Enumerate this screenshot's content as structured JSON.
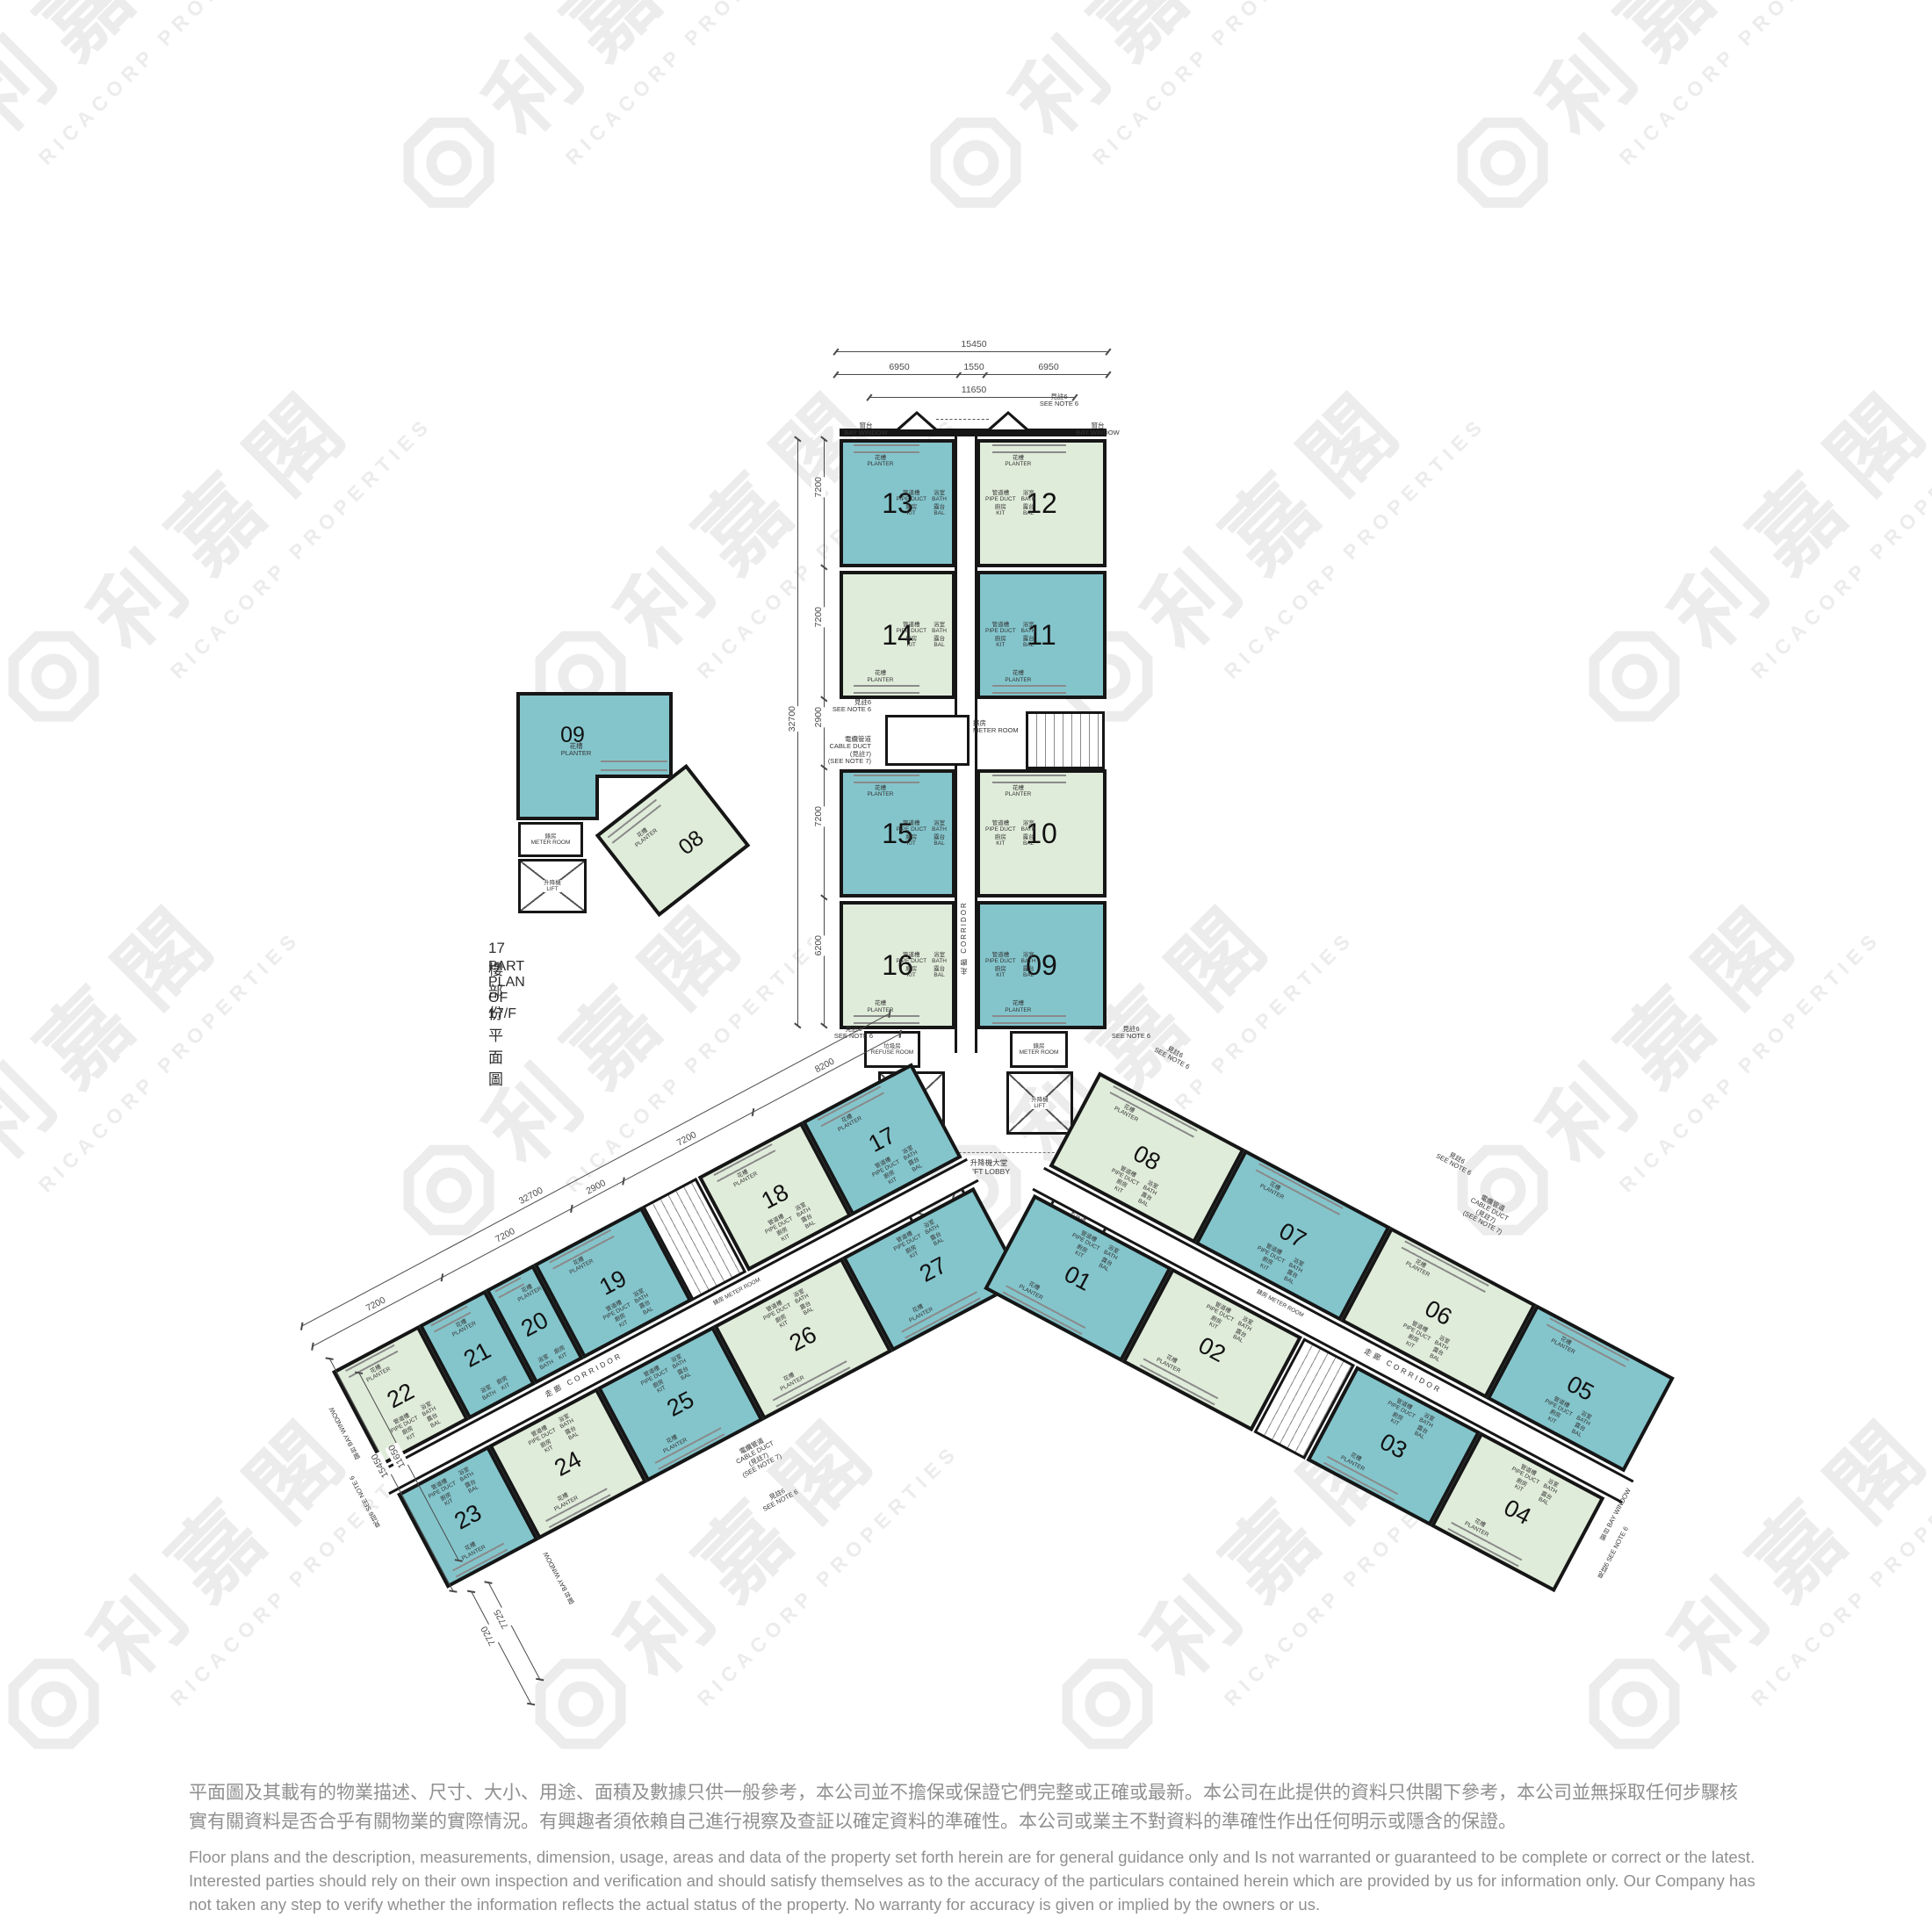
{
  "brand": {
    "zh": "利嘉閣",
    "en": "RICACORP PROPERTIES"
  },
  "colors": {
    "teal": "#84c5cc",
    "green": "#e0ecda",
    "wall": "#161616",
    "watermark": "#ececec",
    "dimension": "#4a4a4a",
    "disclaimer": "#909090"
  },
  "labels": {
    "planter_zh": "花槽",
    "planter_en": "PLANTER",
    "bay_zh": "窗台",
    "bay_en": "BAY WINDOW",
    "bath_zh": "浴室",
    "bath_en": "BATH",
    "kit_zh": "廚房",
    "kit_en": "KIT",
    "bal_zh": "露台",
    "bal_en": "BAL",
    "pipe_zh": "管道槽",
    "pipe_en": "PIPE DUCT",
    "corridor_zh": "走廊",
    "corridor_en": "CORRIDOR",
    "meter_zh": "錶房",
    "meter_en": "METER ROOM",
    "refuse_zh": "垃圾房",
    "refuse_en": "REFUSE ROOM",
    "lift_zh": "升降機",
    "lift_en": "LIFT",
    "lobby_zh": "升降機大堂",
    "lobby_en": "LIFT LOBBY",
    "cable_zh": "電纜管道",
    "cable_en": "CABLE DUCT",
    "note6_zh": "見註6",
    "note6_en": "SEE NOTE 6",
    "note7_zh": "(見註7)",
    "note7_en": "(SEE NOTE 7)",
    "fs_zh": "消防泵房",
    "fs_en": "F.S. PUMP ROOM"
  },
  "north_wing": {
    "rows": [
      [
        {
          "no": "13",
          "color": "teal",
          "planter": "top"
        },
        {
          "no": "12",
          "color": "green",
          "planter": "top"
        }
      ],
      [
        {
          "no": "14",
          "color": "green",
          "planter": "bottom"
        },
        {
          "no": "11",
          "color": "teal",
          "planter": "bottom"
        }
      ],
      [
        {
          "no": "15",
          "color": "teal",
          "planter": "top"
        },
        {
          "no": "10",
          "color": "green",
          "planter": "top"
        }
      ],
      [
        {
          "no": "16",
          "color": "green",
          "planter": "bottom"
        },
        {
          "no": "09",
          "color": "teal",
          "planter": "bottom"
        }
      ]
    ]
  },
  "left_wing": {
    "upper": [
      {
        "no": "17",
        "color": "teal"
      },
      {
        "no": "18",
        "color": "green"
      },
      {
        "no": "19",
        "color": "teal"
      },
      {
        "no": "20",
        "color": "teal"
      },
      {
        "no": "21",
        "color": "teal"
      },
      {
        "no": "22",
        "color": "green"
      }
    ],
    "lower": [
      {
        "no": "27",
        "color": "teal"
      },
      {
        "no": "26",
        "color": "green"
      },
      {
        "no": "25",
        "color": "teal"
      },
      {
        "no": "24",
        "color": "green"
      },
      {
        "no": "23",
        "color": "teal"
      }
    ]
  },
  "right_wing": {
    "upper": [
      {
        "no": "08",
        "color": "green"
      },
      {
        "no": "07",
        "color": "teal"
      },
      {
        "no": "06",
        "color": "green"
      },
      {
        "no": "05",
        "color": "teal"
      }
    ],
    "lower": [
      {
        "no": "01",
        "color": "teal"
      },
      {
        "no": "02",
        "color": "green"
      },
      {
        "no": "03",
        "color": "teal"
      },
      {
        "no": "04",
        "color": "green"
      }
    ]
  },
  "part_plan": {
    "caption_zh": "17樓部份平面圖",
    "caption_en": "PART PLAN OF 17/F",
    "units": [
      {
        "no": "09",
        "color": "teal"
      },
      {
        "no": "08",
        "color": "green"
      }
    ]
  },
  "dimensions": {
    "top_total": "15450",
    "top_segments": [
      "6950",
      "1550",
      "6950"
    ],
    "top_inner": "11650",
    "north_left_segments": [
      "7200",
      "7200",
      "2900",
      "7200",
      "6200"
    ],
    "north_left_total": "32700",
    "left_wing_segments": [
      "8200",
      "7200",
      "2900",
      "7200",
      "7200"
    ],
    "left_wing_total": "32700",
    "left_wing_end": [
      "15450",
      "11650"
    ],
    "left_wing_tip": [
      "7725",
      "7720"
    ],
    "hub": "5800"
  },
  "disclaimer": {
    "zh": "平面圖及其載有的物業描述、尺寸、大小、用途、面積及數據只供一般參考，本公司並不擔保或保證它們完整或正確或最新。本公司在此提供的資料只供閣下參考，本公司並無採取任何步驟核實有關資料是否合乎有關物業的實際情況。有興趣者須依賴自己進行視察及查証以確定資料的準確性。本公司或業主不對資料的準確性作出任何明示或隱含的保證。",
    "en": "Floor plans and the description, measurements, dimension, usage, areas and data of the property set forth herein are for general guidance only and Is not warranted or guaranteed to be complete or correct or the latest. Interested parties should rely on their own inspection and verification and should satisfy themselves as to the accuracy of the particulars contained herein which are provided by us for information only.  Our Company has not taken any step to verify whether the information reflects the actual status of the property.  No warranty for accuracy is given or implied by the owners or us."
  }
}
